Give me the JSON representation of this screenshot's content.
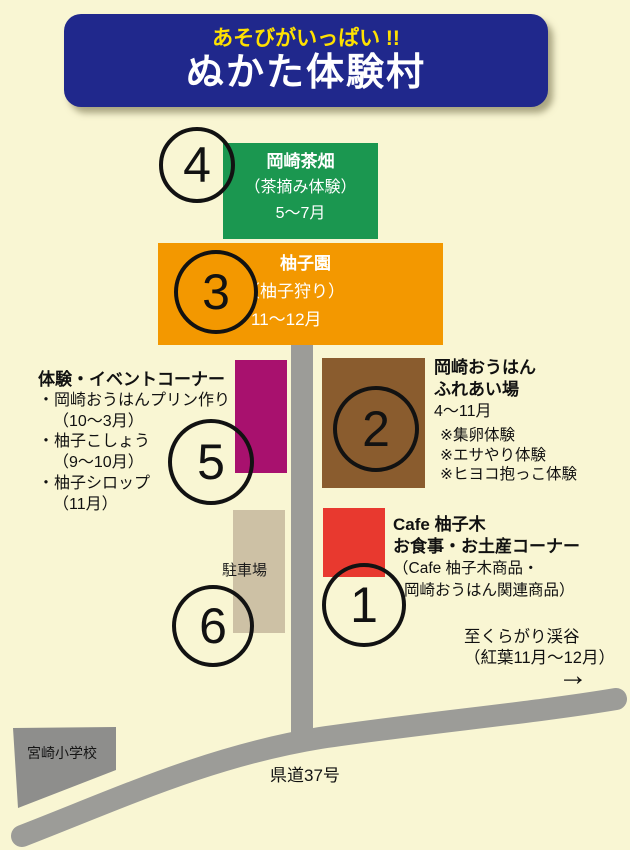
{
  "header": {
    "tagline": "あそびがいっぱい !!",
    "title": "ぬかた体験村"
  },
  "colors": {
    "background": "#F9F6D3",
    "banner_blue": "#20288C",
    "tagline_yellow": "#FFE100",
    "tea_green": "#1B9750",
    "yuzu_orange": "#F39800",
    "fureai_brown": "#8A5C2E",
    "event_magenta": "#A8116E",
    "cafe_red": "#E8392F",
    "parking_tan": "#CDC1A5",
    "road_gray": "#9C9C98",
    "school_gray": "#8E8E8C"
  },
  "sites": {
    "tea": {
      "number": "4",
      "name": "岡崎茶畑",
      "subtitle": "（茶摘み体験）",
      "period": "5〜7月"
    },
    "yuzu": {
      "number": "3",
      "name": "柚子園",
      "subtitle": "（柚子狩り）",
      "period": "11〜12月"
    },
    "fureai": {
      "number": "2",
      "name_line1": "岡崎おうはん",
      "name_line2": "ふれあい場",
      "period": "4〜11月",
      "activities": [
        "※集卵体験",
        "※エサやり体験",
        "※ヒヨコ抱っこ体験"
      ]
    },
    "event": {
      "number": "5",
      "title": "体験・イベントコーナー",
      "items": [
        {
          "label": "・岡崎おうはんプリン作り",
          "period": "（10〜3月）"
        },
        {
          "label": "・柚子こしょう",
          "period": "（9〜10月）"
        },
        {
          "label": "・柚子シロップ",
          "period": "（11月）"
        }
      ]
    },
    "cafe": {
      "number": "1",
      "name": "Cafe 柚子木",
      "subtitle": "お食事・お土産コーナー",
      "note_line1": "（Cafe 柚子木商品・",
      "note_line2": "岡崎おうはん関連商品）"
    },
    "parking": {
      "number": "6",
      "label": "駐車場"
    }
  },
  "map": {
    "school_label": "宮崎小学校",
    "road_label": "県道37号",
    "destination_line1": "至くらがり渓谷",
    "destination_line2": "（紅葉11月〜12月）",
    "arrow": "→"
  }
}
